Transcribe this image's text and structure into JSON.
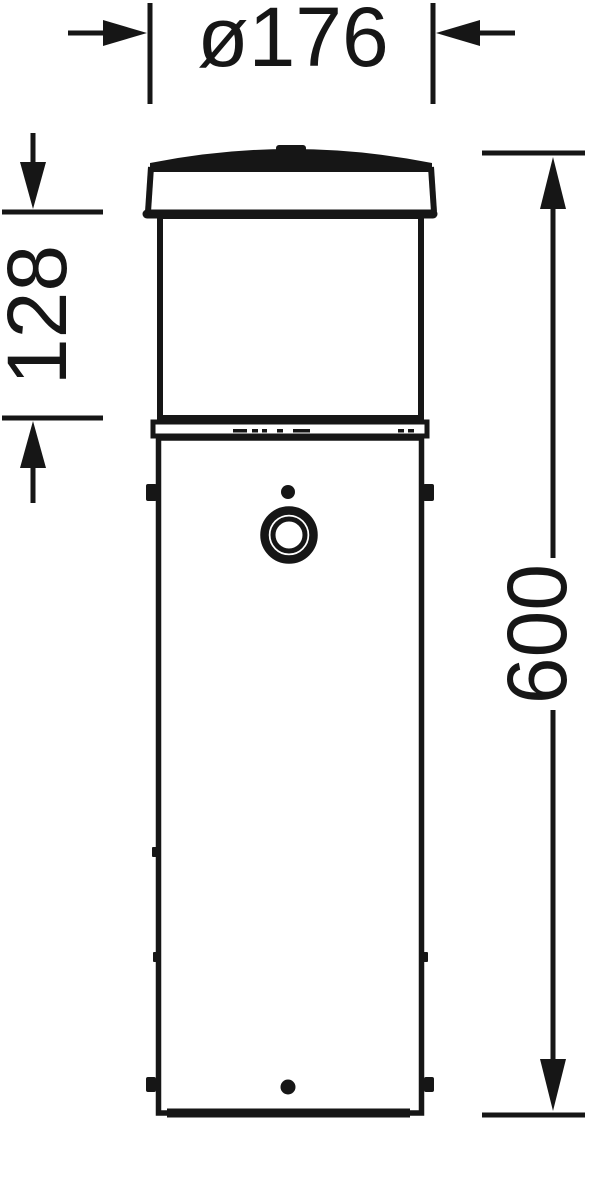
{
  "drawing": {
    "kind": "technical-dimension-drawing",
    "subject": "bollard-luminaire-front-elevation",
    "ink_color": "#161616",
    "paper_color": "#ffffff",
    "labels": {
      "diameter": "ø176",
      "head_height": "128",
      "overall_height": "600"
    }
  }
}
